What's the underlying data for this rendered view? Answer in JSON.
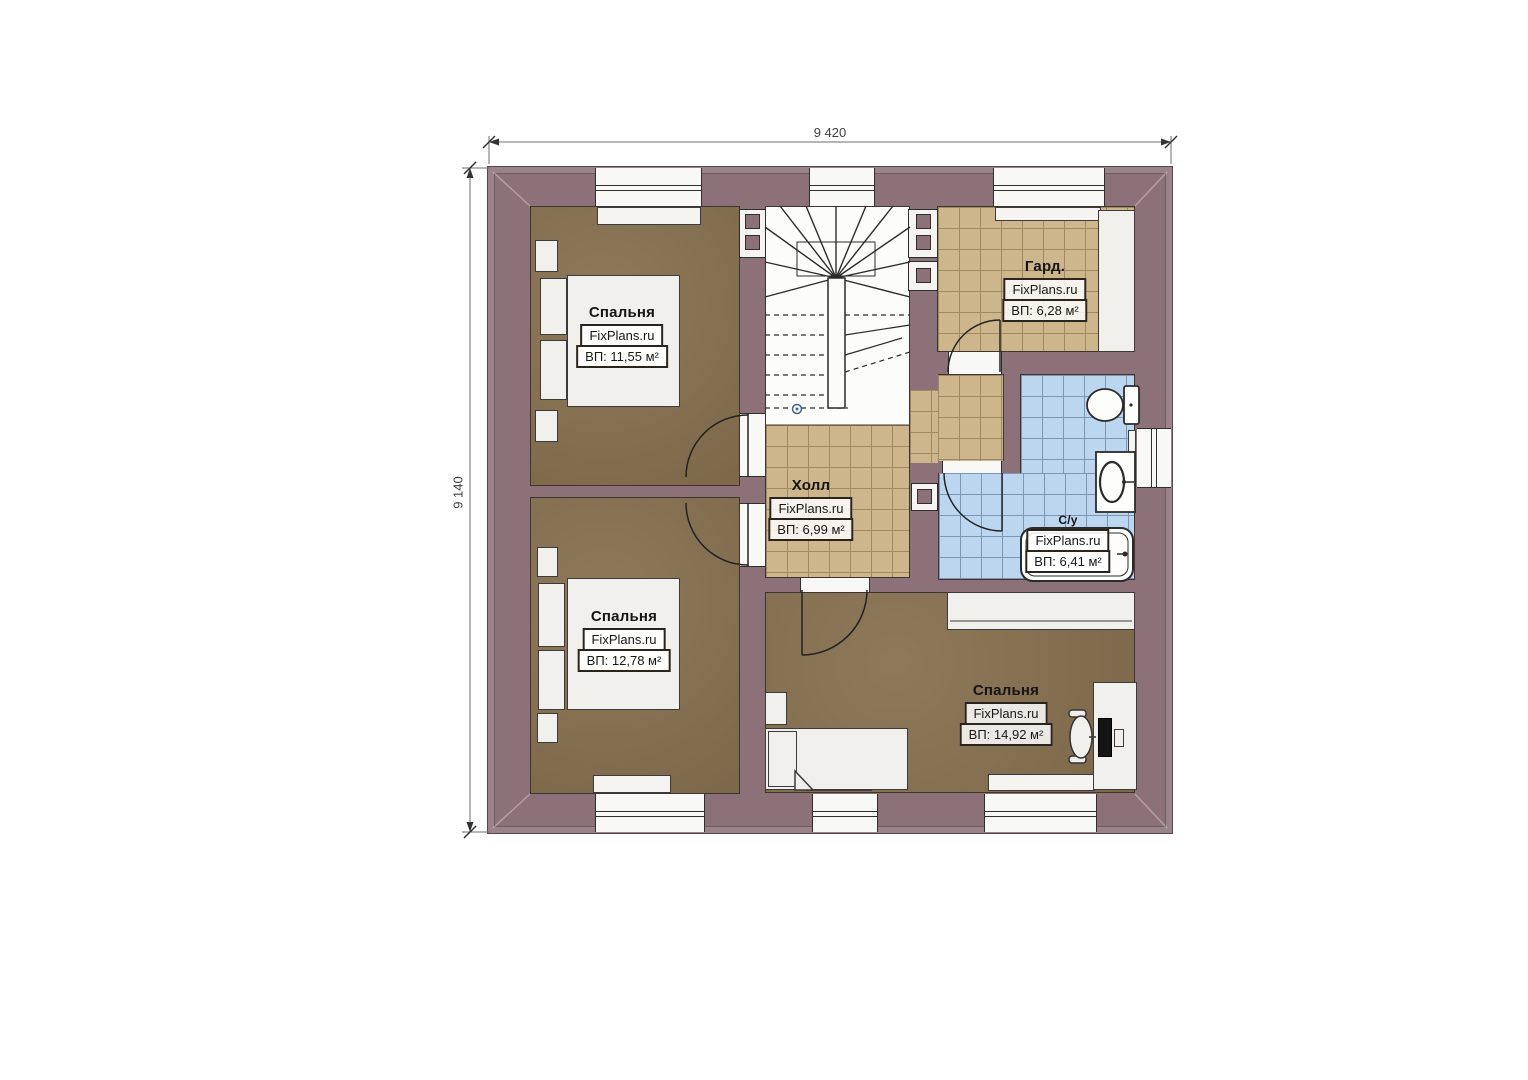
{
  "plan_title": "floor-plan-second-storey",
  "dimensions": {
    "top": "9 420",
    "left": "9 140"
  },
  "rooms": {
    "bedroom_top_left": {
      "name": "Спальня",
      "watermark": "FixPlans.ru",
      "area": "ВП: 11,55 м²"
    },
    "bedroom_bottom_left": {
      "name": "Спальня",
      "watermark": "FixPlans.ru",
      "area": "ВП: 12,78 м²"
    },
    "bedroom_bottom_right": {
      "name": "Спальня",
      "watermark": "FixPlans.ru",
      "area": "ВП: 14,92 м²"
    },
    "hall": {
      "name": "Холл",
      "watermark": "FixPlans.ru",
      "area": "ВП: 6,99 м²"
    },
    "wardrobe": {
      "name": "Гард.",
      "watermark": "FixPlans.ru",
      "area": "ВП: 6,28 м²"
    },
    "bathroom": {
      "name": "С/у",
      "watermark": "FixPlans.ru",
      "area": "ВП: 6,41 м²"
    }
  },
  "colors": {
    "wall": "#8c7278",
    "wall_outer_band": "#9a848a",
    "bedroom_floor": "#877050",
    "hall_tile": "#cdb58c",
    "bathroom_tile": "#bcd6f0",
    "fixture_white": "#f1f0ed"
  }
}
